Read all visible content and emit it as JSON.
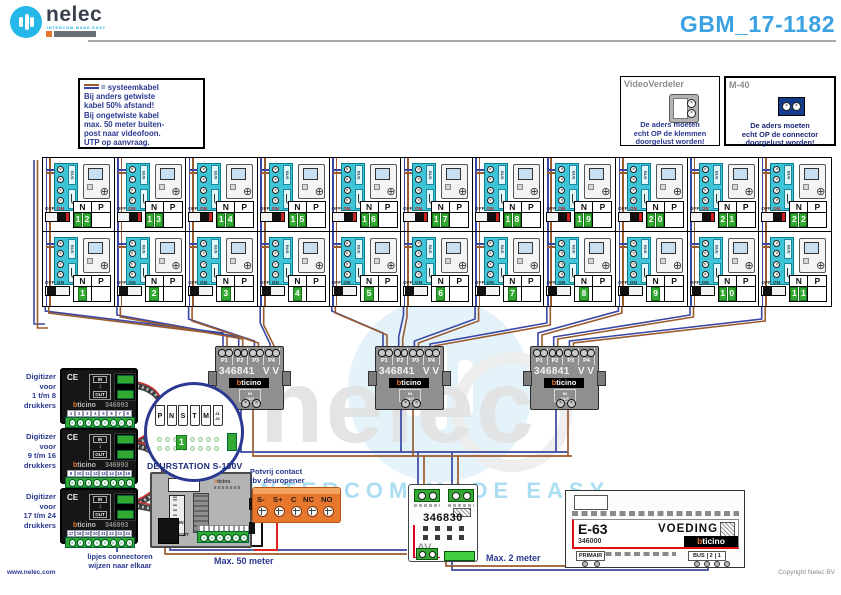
{
  "page": {
    "doc_id": "GBM_17-1182",
    "website": "www.nelec.com",
    "copyright": "Copyright Nelec BV"
  },
  "logo": {
    "name": "nelec",
    "tagline": "INTERCOM MADE EASY"
  },
  "watermark": {
    "text": "nelec",
    "tagline": "INTERCOM MADE EASY"
  },
  "note_box": {
    "legend": "= systeemkabel",
    "lines": [
      "Bij anders getwiste",
      "kabel 50% afstand!",
      "Bij ongetwiste kabel",
      "max. 50 meter buiten-",
      "post naar videofoon.",
      "UTP op aanvraag."
    ]
  },
  "verdeler_box": {
    "title": "VideoVerdeler",
    "caption": [
      "De aders moeten",
      "echt OP de klemmen",
      "doorgelust worden!"
    ]
  },
  "m40_box": {
    "title": "M-40",
    "caption": [
      "De aders moeten",
      "echt OP de connector",
      "doorgelust worden!"
    ]
  },
  "grid": {
    "headers": {
      "n": "N",
      "p": "P"
    },
    "bus_label": "BUS",
    "off_label": "OFF",
    "on_label": "ON",
    "top_numbers": [
      "12",
      "13",
      "14",
      "15",
      "16",
      "17",
      "18",
      "19",
      "20",
      "21",
      "22"
    ],
    "bottom_numbers": [
      "1",
      "2",
      "3",
      "4",
      "5",
      "6",
      "7",
      "8",
      "9",
      "10",
      "11"
    ]
  },
  "distributor": {
    "model": "346841",
    "vv": "V V",
    "ports": [
      "P1",
      "P2",
      "P3",
      "P4"
    ],
    "brand_b": "b",
    "brand_rest": "ticino",
    "in": "IN",
    "out": "OUT"
  },
  "digitizers": {
    "shared": {
      "ce": "CE",
      "in": "IN",
      "out": "OUT",
      "brand_b": "b",
      "brand_rest": "ticino",
      "model": "346993",
      "caption_head": "Digitizer",
      "caption_mid": "voor",
      "caption_tail": "drukkers"
    },
    "items": [
      {
        "range": "1 t/m 8",
        "numbers": [
          "1",
          "2",
          "3",
          "4",
          "5",
          "6",
          "7",
          "8"
        ]
      },
      {
        "range": "9 t/m 16",
        "numbers": [
          "9",
          "10",
          "11",
          "12",
          "13",
          "14",
          "15",
          "16"
        ]
      },
      {
        "range": "17 t/m 24",
        "numbers": [
          "17",
          "18",
          "19",
          "20",
          "21",
          "22",
          "23",
          "24"
        ]
      }
    ]
  },
  "connector_note": [
    "lipjes connectoren",
    "wijzen naar elkaar"
  ],
  "detail_circle": {
    "terminals": [
      "P",
      "N",
      "S",
      "T",
      "M",
      "J1",
      "J2"
    ],
    "badge": "1"
  },
  "door_station": {
    "title": "DEURSTATION S-130V",
    "in": "IN",
    "out": "OUT",
    "brand_b": "b",
    "brand_rest": "ticino"
  },
  "dry_contact": {
    "caption": [
      "Potvrij contact",
      "tbv deuropener"
    ],
    "terminals": [
      "S-",
      "S+",
      "C",
      "NC",
      "NO"
    ]
  },
  "adapter": {
    "model": "346830",
    "av": "AV"
  },
  "psu": {
    "model": "E-63",
    "title": "VOEDING",
    "number": "346000",
    "brand_b": "b",
    "brand_rest": "ticino",
    "primair": "PRIMAIR",
    "bus": [
      "BUS",
      "2",
      "1"
    ]
  },
  "notes": {
    "max50": "Max. 50 meter",
    "max2": "Max. 2 meter"
  },
  "colors": {
    "brown": "#9A5B2E",
    "blue": "#3847A3",
    "accent": "#2B3990",
    "cyan": "#3EC4D6",
    "green": "#33A833",
    "orange": "#E8772E"
  }
}
